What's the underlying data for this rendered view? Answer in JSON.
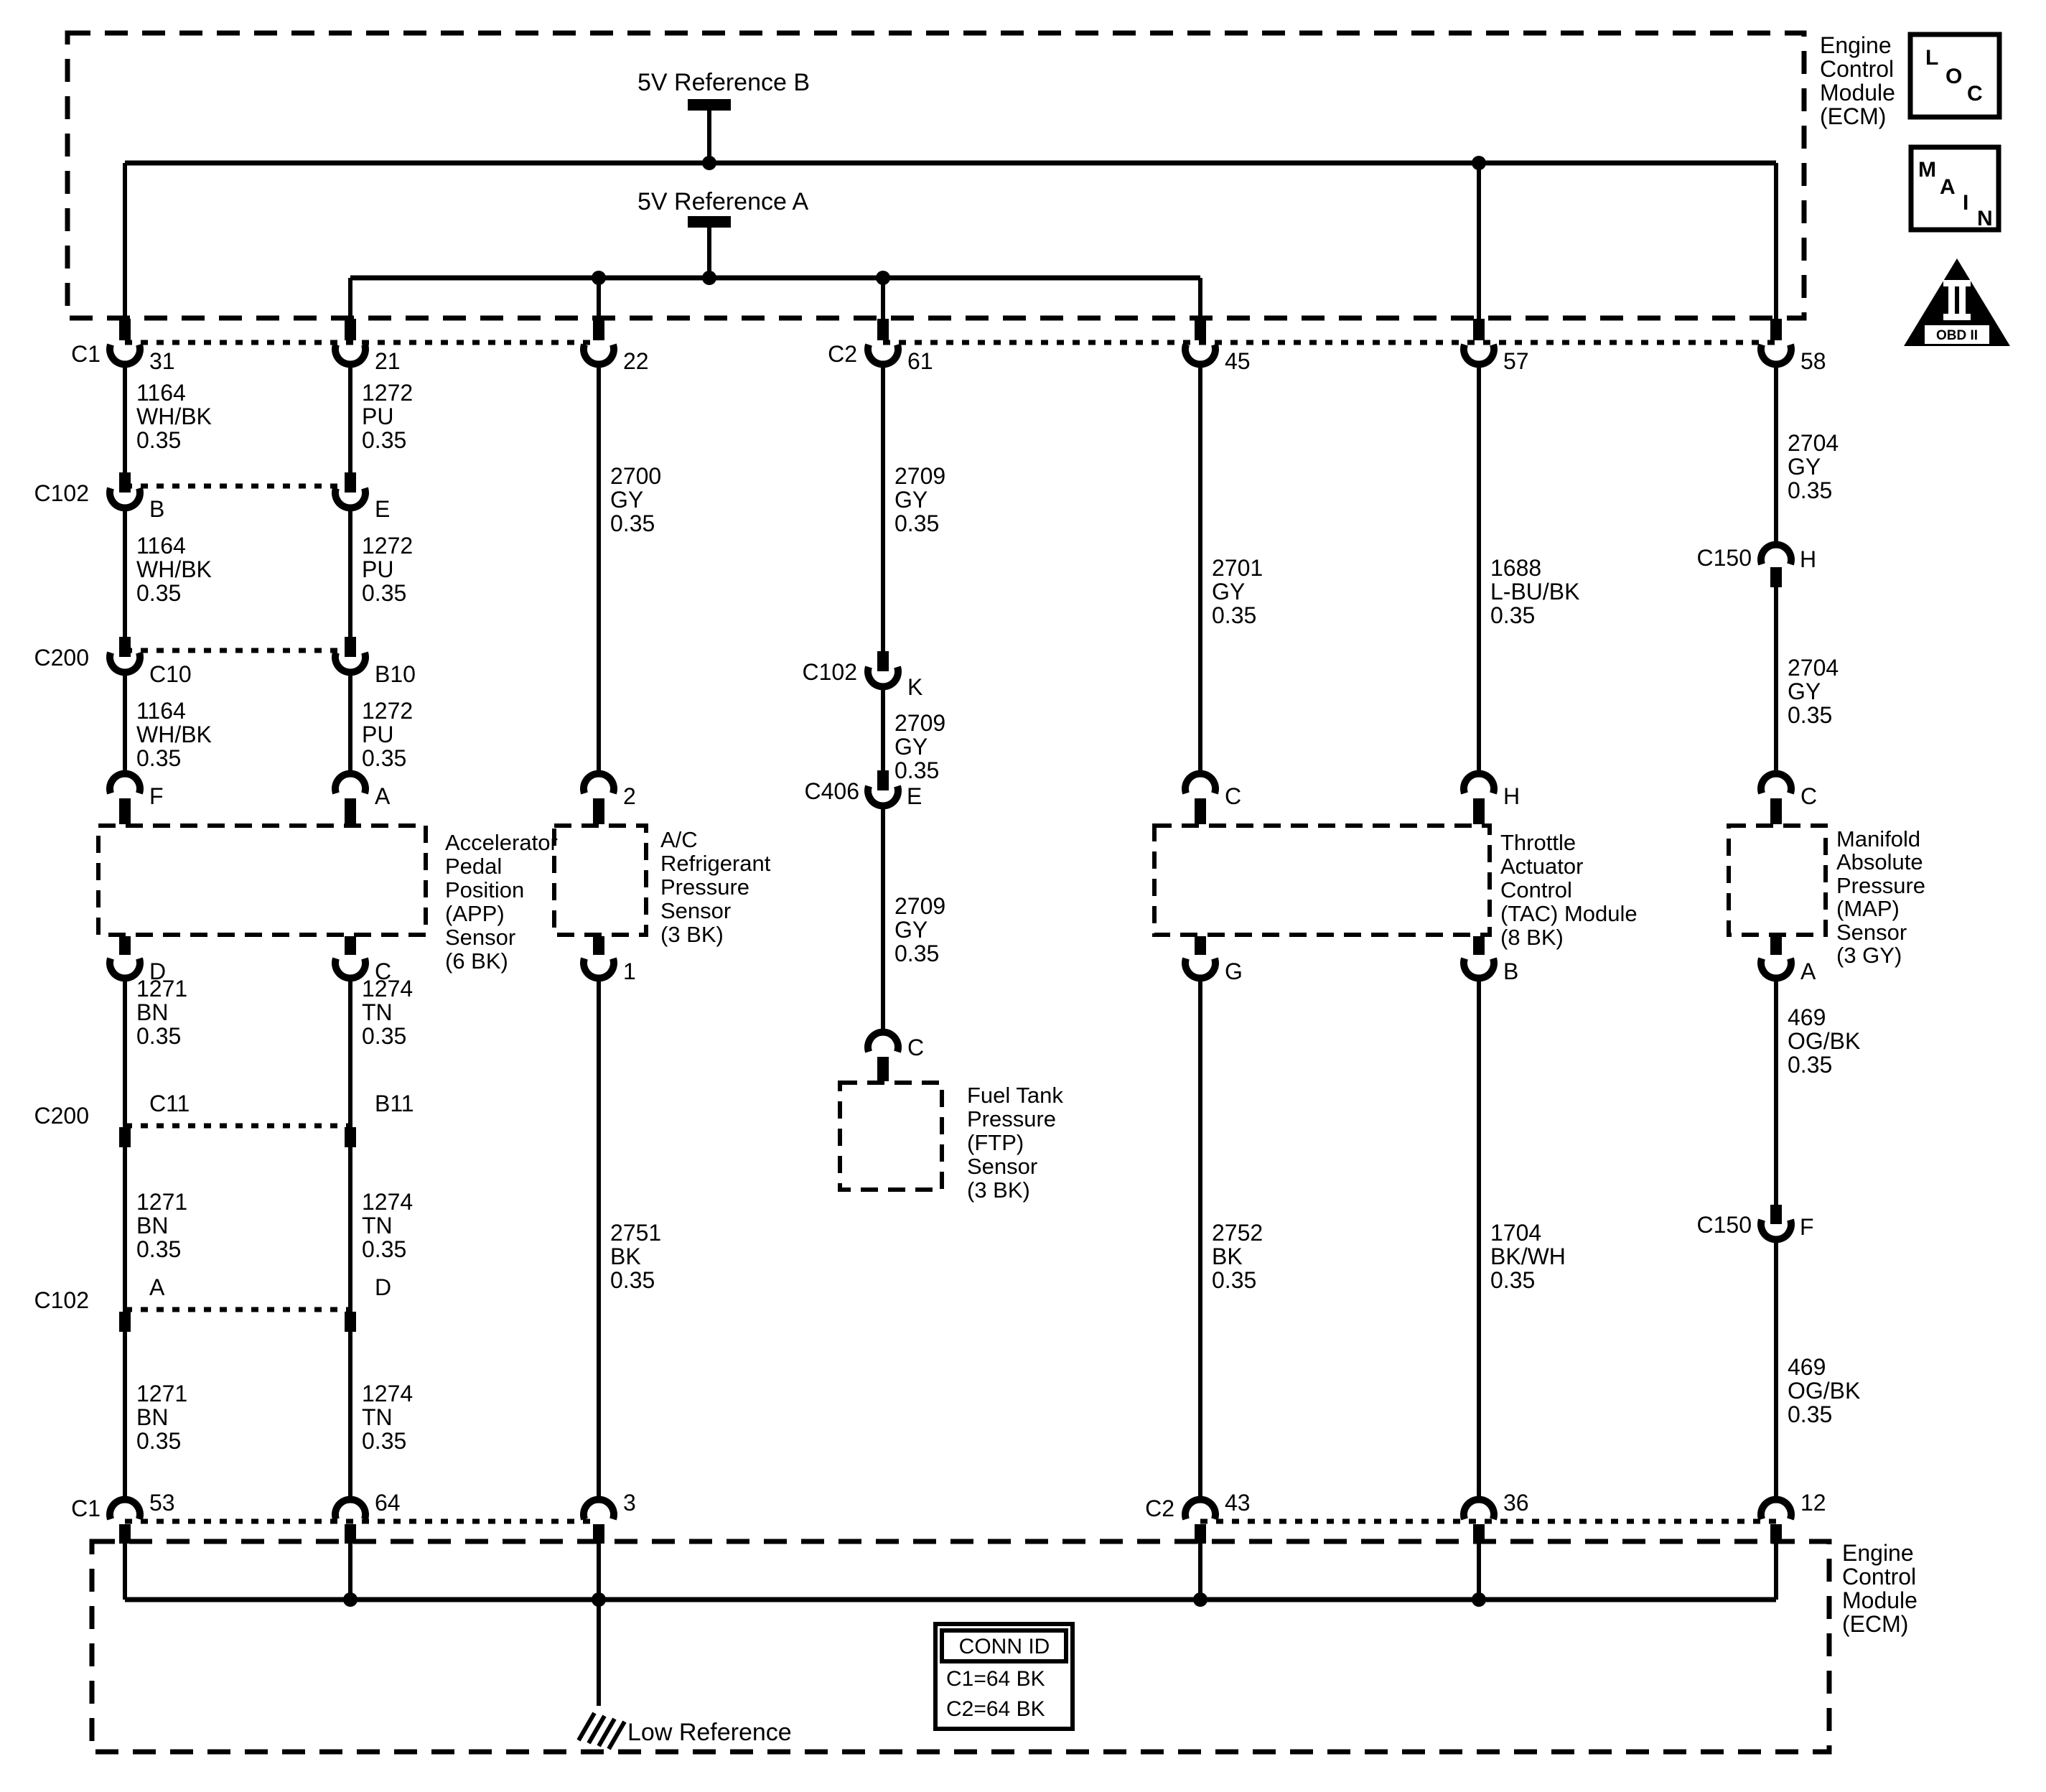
{
  "page": {
    "background": "#ffffff",
    "ink": "#000000"
  },
  "ecm_top": {
    "lines": [
      "Engine",
      "Control",
      "Module",
      "(ECM)"
    ]
  },
  "ecm_bottom": {
    "lines": [
      "Engine",
      "Control",
      "Module",
      "(ECM)"
    ]
  },
  "refs": {
    "b": "5V Reference B",
    "a": "5V Reference A",
    "low": "Low Reference"
  },
  "badges": {
    "loc": {
      "letters": [
        "L",
        "O",
        "C"
      ]
    },
    "main": {
      "letters": [
        "M",
        "A",
        "I",
        "N"
      ]
    },
    "obd": {
      "label": "OBD II"
    }
  },
  "conn_id": {
    "title": "CONN ID",
    "rows": [
      "C1=64 BK",
      "C2=64 BK"
    ]
  },
  "top_row": {
    "c1": "C1",
    "c2": "C2",
    "pins": [
      "31",
      "21",
      "22",
      "61",
      "45",
      "57",
      "58"
    ]
  },
  "bottom_row": {
    "c1": "C1",
    "c2": "C2",
    "pins": [
      "53",
      "64",
      "3",
      "43",
      "36",
      "12"
    ]
  },
  "inline": {
    "c102_top": {
      "name": "C102",
      "pins": [
        "B",
        "E"
      ]
    },
    "c200_top": {
      "name": "C200",
      "pins": [
        "C10",
        "B10"
      ]
    },
    "c102_k": {
      "name": "C102",
      "pin": "K"
    },
    "c406": {
      "name": "C406",
      "pin": "E"
    },
    "c150_h": {
      "name": "C150",
      "pin": "H"
    },
    "c150_f": {
      "name": "C150",
      "pin": "F"
    },
    "c200_bottom": {
      "name": "C200",
      "pins": [
        "C11",
        "B11"
      ]
    },
    "c102_bottom": {
      "name": "C102",
      "pins": [
        "A",
        "D"
      ]
    }
  },
  "sensor_pins": {
    "top": [
      "F",
      "A",
      "2",
      "C",
      "H",
      "C"
    ],
    "bottom": [
      "D",
      "C",
      "1",
      "G",
      "B",
      "A"
    ],
    "ftp": "C"
  },
  "sensors": {
    "app": [
      "Accelerator",
      "Pedal",
      "Position",
      "(APP)",
      "Sensor",
      "(6 BK)"
    ],
    "ac": [
      "A/C",
      "Refrigerant",
      "Pressure",
      "Sensor",
      "(3 BK)"
    ],
    "tac": [
      "Throttle",
      "Actuator",
      "Control",
      "(TAC) Module",
      "(8 BK)"
    ],
    "map": [
      "Manifold",
      "Absolute",
      "Pressure",
      "(MAP)",
      "Sensor",
      "(3 GY)"
    ],
    "ftp": [
      "Fuel Tank",
      "Pressure",
      "(FTP)",
      "Sensor",
      "(3 BK)"
    ]
  },
  "wire_labels": {
    "w1164_1": [
      "1164",
      "WH/BK",
      "0.35"
    ],
    "w1164_2": [
      "1164",
      "WH/BK",
      "0.35"
    ],
    "w1164_3": [
      "1164",
      "WH/BK",
      "0.35"
    ],
    "w1272_1": [
      "1272",
      "PU",
      "0.35"
    ],
    "w1272_2": [
      "1272",
      "PU",
      "0.35"
    ],
    "w1272_3": [
      "1272",
      "PU",
      "0.35"
    ],
    "w2700": [
      "2700",
      "GY",
      "0.35"
    ],
    "w2709_1": [
      "2709",
      "GY",
      "0.35"
    ],
    "w2709_2": [
      "2709",
      "GY",
      "0.35"
    ],
    "w2709_3": [
      "2709",
      "GY",
      "0.35"
    ],
    "w2701": [
      "2701",
      "GY",
      "0.35"
    ],
    "w1688": [
      "1688",
      "L-BU/BK",
      "0.35"
    ],
    "w2704_1": [
      "2704",
      "GY",
      "0.35"
    ],
    "w2704_2": [
      "2704",
      "GY",
      "0.35"
    ],
    "w1271_1": [
      "1271",
      "BN",
      "0.35"
    ],
    "w1271_2": [
      "1271",
      "BN",
      "0.35"
    ],
    "w1271_3": [
      "1271",
      "BN",
      "0.35"
    ],
    "w1274_1": [
      "1274",
      "TN",
      "0.35"
    ],
    "w1274_2": [
      "1274",
      "TN",
      "0.35"
    ],
    "w1274_3": [
      "1274",
      "TN",
      "0.35"
    ],
    "w2751": [
      "2751",
      "BK",
      "0.35"
    ],
    "w2752": [
      "2752",
      "BK",
      "0.35"
    ],
    "w1704": [
      "1704",
      "BK/WH",
      "0.35"
    ],
    "w469_1": [
      "469",
      "OG/BK",
      "0.35"
    ],
    "w469_2": [
      "469",
      "OG/BK",
      "0.35"
    ]
  }
}
